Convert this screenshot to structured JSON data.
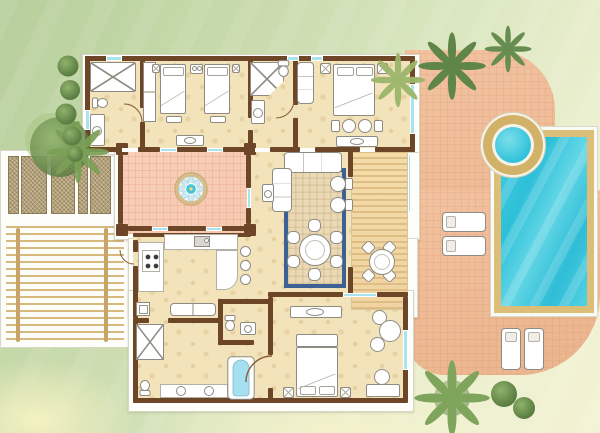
{
  "scene": {
    "type": "architectural floor plan",
    "view": "top-down",
    "subject": "villa with private pool, jacuzzi, fountain courtyard, timber sun deck and pergola"
  },
  "palette": {
    "lawn_dark": "#b7cf9c",
    "lawn_mid": "#d9e6bf",
    "lawn_pale": "#f4f2d4",
    "terrace": "#f2c2a0",
    "terrace_deep": "#eab48c",
    "courtyard": "#f6c9b0",
    "floor": "#f3e3bb",
    "wall": "#6d4527",
    "window": "#a8e4ef",
    "white": "#fdfdf9",
    "deck_wood": "#f0d3a1",
    "deck_slat": "#dfbe86",
    "pool_water": "#35c5dd",
    "pool_frame": "#dcbe78",
    "jacuzzi_ring": "#d2b269",
    "rug_border": "#3d6095",
    "rug_field": "#ead9b4",
    "tree_dark": "#5f8549",
    "tree_light": "#9ab465",
    "planter": "#b3a077",
    "pergola": "#d9b87e",
    "fixture_outline": "#8e8b83",
    "bath_water": "#a5e0f0"
  },
  "rooms": [
    {
      "name": "walk-in closet and bathroom",
      "features": [
        "closet",
        "toilet",
        "basin"
      ]
    },
    {
      "name": "twin guest bedroom",
      "features": [
        "2 single beds",
        "wardrobe",
        "nightstands",
        "benches",
        "console"
      ]
    },
    {
      "name": "en-suite shower room",
      "features": [
        "corner shower",
        "toilet",
        "basin"
      ]
    },
    {
      "name": "double bedroom upper",
      "features": [
        "double bed",
        "chaise",
        "pouf bench",
        "luggage bench"
      ]
    },
    {
      "name": "fountain courtyard",
      "features": [
        "flower fountain",
        "4 columns",
        "tiled floor"
      ]
    },
    {
      "name": "living and dining room",
      "features": [
        "sectional sofa",
        "2 armchairs",
        "side table",
        "round dining table",
        "6 chairs",
        "rug"
      ]
    },
    {
      "name": "kitchen",
      "features": [
        "stove",
        "sink",
        "breakfast bar",
        "3 bar stools"
      ]
    },
    {
      "name": "hallway",
      "features": [
        "bench",
        "mirror console"
      ]
    },
    {
      "name": "guest wc",
      "features": [
        "toilet",
        "basin"
      ]
    },
    {
      "name": "family bathroom",
      "features": [
        "shower",
        "bathtub",
        "double basin vanity",
        "toilet"
      ]
    },
    {
      "name": "master bedroom lower",
      "features": [
        "double bed",
        "nightstands",
        "round table with 2 chairs",
        "desk",
        "luggage bench"
      ]
    },
    {
      "name": "timber sun deck",
      "features": [
        "round table",
        "4 chairs"
      ]
    },
    {
      "name": "paved terrace",
      "features": [
        "tiled paving"
      ]
    },
    {
      "name": "swimming pool",
      "features": [
        "rectangular pool"
      ]
    },
    {
      "name": "jacuzzi",
      "features": [
        "round hot tub"
      ]
    },
    {
      "name": "pergola patio",
      "features": [
        "timber slats",
        "5 planters"
      ]
    },
    {
      "name": "garden",
      "features": [
        "lawn",
        "palms",
        "bushes"
      ]
    }
  ],
  "counts": {
    "bedrooms": 3,
    "bathrooms": 3,
    "guest_wc": 1,
    "sun_loungers": 4,
    "bar_stools": 3,
    "dining_seats": 6,
    "deck_seats": 4,
    "planters": 5,
    "courtyard_columns": 4
  },
  "generated": {
    "planters": {
      "cls": "planter",
      "name": "planter",
      "rects": [
        [
          8,
          156,
          11,
          58
        ],
        [
          21,
          156,
          26,
          58
        ],
        [
          51,
          156,
          24,
          58
        ],
        [
          78,
          156,
          10,
          58
        ],
        [
          90,
          156,
          21,
          58
        ]
      ]
    },
    "bar_stools": {
      "cls": "stool",
      "name": "bar-stool",
      "rects": [
        [
          240,
          246,
          11,
          11
        ],
        [
          240,
          260,
          11,
          11
        ],
        [
          240,
          274,
          11,
          11
        ]
      ]
    },
    "dining_chairs": {
      "cls": "chair",
      "name": "dining-chair",
      "rects": [
        [
          308,
          219,
          13,
          13
        ],
        [
          330,
          231,
          13,
          13
        ],
        [
          330,
          255,
          13,
          13
        ],
        [
          308,
          268,
          13,
          13
        ],
        [
          287,
          255,
          13,
          13
        ],
        [
          287,
          231,
          13,
          13
        ]
      ]
    },
    "deck_chairs": {
      "cls": "chair rot45",
      "name": "deck-chair",
      "rects": [
        [
          363,
          242,
          11,
          11
        ],
        [
          384,
          242,
          11,
          11
        ],
        [
          363,
          270,
          11,
          11
        ],
        [
          384,
          270,
          11,
          11
        ]
      ]
    }
  }
}
